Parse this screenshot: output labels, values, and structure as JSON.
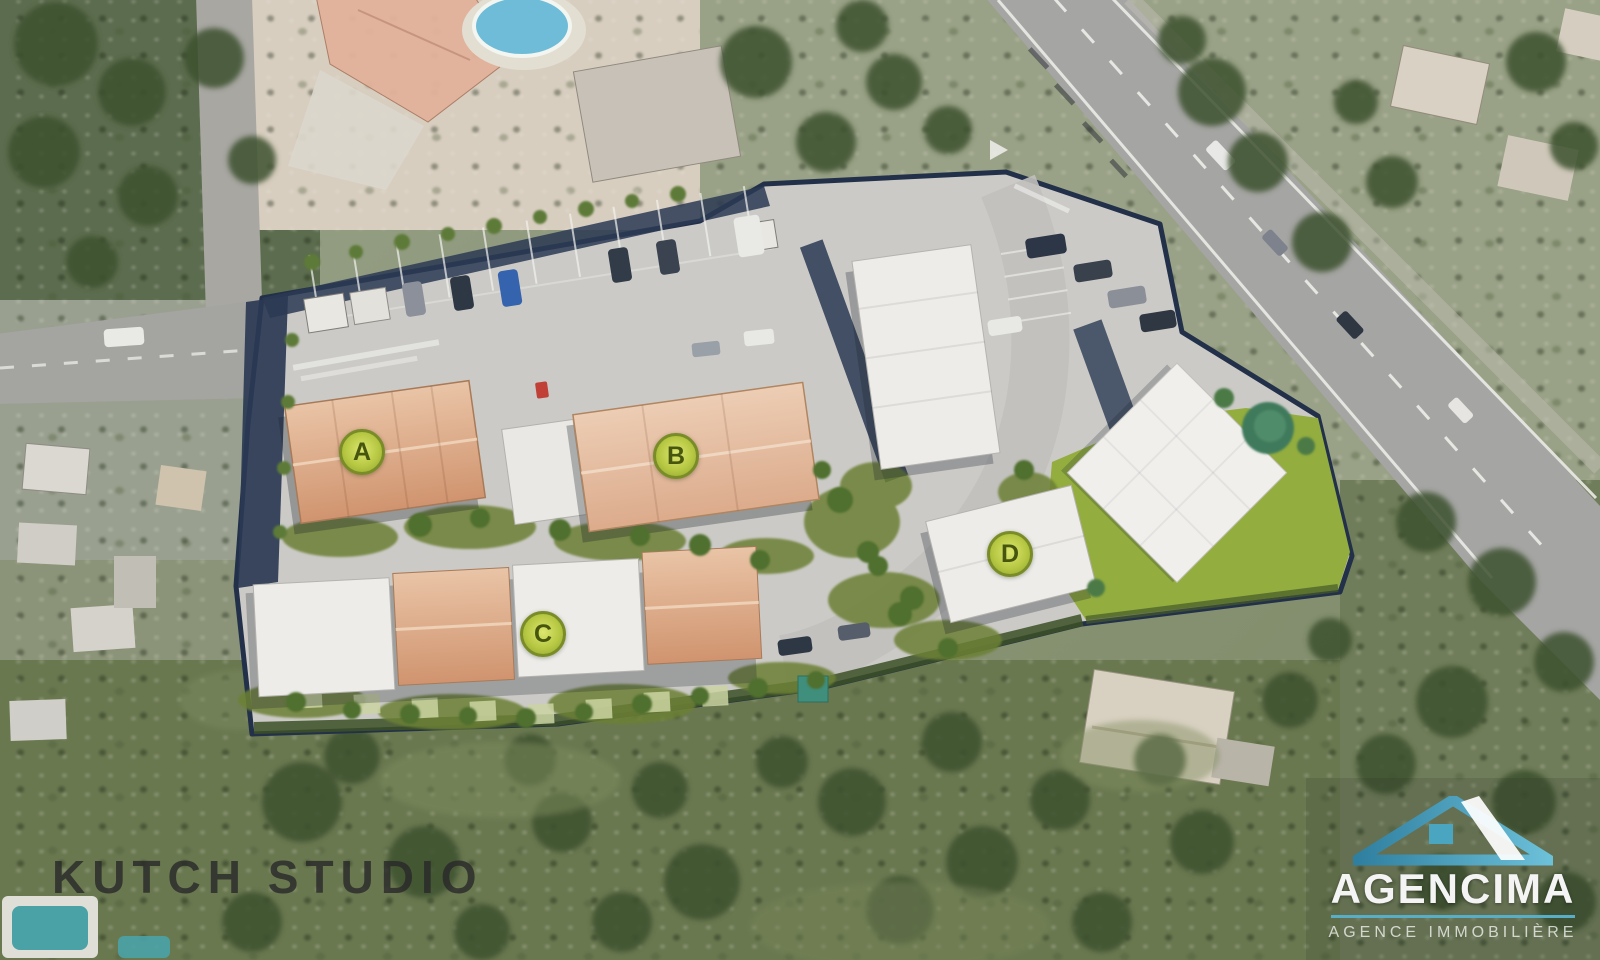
{
  "watermark": {
    "text": "KUTCH STUDIO"
  },
  "brand": {
    "name": "AGENCIMA",
    "tagline": "AGENCE IMMOBILIÈRE",
    "accent": "#58aec6"
  },
  "plan": {
    "buildings": [
      {
        "label": "A"
      },
      {
        "label": "B"
      },
      {
        "label": "C"
      },
      {
        "label": "D"
      }
    ],
    "marker": {
      "fill": "#b7c843",
      "ring": "#798c28",
      "text_color": "#47560f"
    }
  },
  "colors": {
    "pavement": "#cbcac6",
    "boundary": "#22304a",
    "terracotta_roof": "#d79f7e",
    "light_roof": "#edece9",
    "lawn": "#93ad3f",
    "hedge": "#3c5026",
    "road": "#a5a5a3",
    "pool": "#6fbcd8"
  }
}
